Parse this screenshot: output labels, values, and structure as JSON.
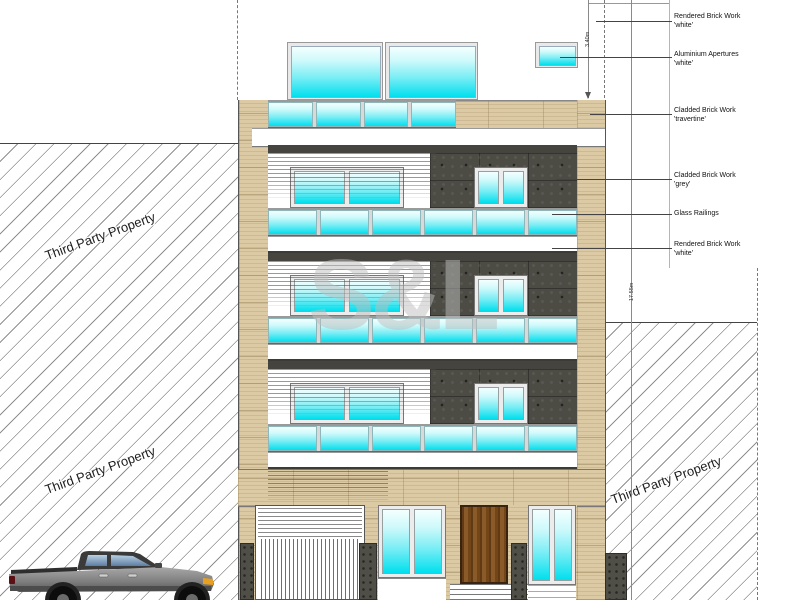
{
  "title": "building-front-elevation",
  "annotations": [
    {
      "label": "Rendered Brick Work",
      "variant": "'white'"
    },
    {
      "label": "Aluminium Apertures",
      "variant": "'white'"
    },
    {
      "label": "Cladded Brick Work",
      "variant": "'travertine'"
    },
    {
      "label": "Cladded Brick Work",
      "variant": "'grey'"
    },
    {
      "label": "Glass Railings",
      "variant": ""
    },
    {
      "label": "Rendered Brick Work",
      "variant": "'white'"
    }
  ],
  "dimensions": {
    "parapet_height": "3.40m",
    "total_height": "17.55m"
  },
  "property": {
    "left_upper": "Third Party Property",
    "left_lower": "Third Party Property",
    "right": "Third Party Property"
  },
  "watermark": "S&L",
  "colors": {
    "glass-top": "#f4ffff",
    "glass-mid": "#7deef5",
    "glass-bottom": "#00dfee",
    "travertine": "#dccaa4",
    "cladding": "#4c4b44",
    "dark-band": "#45443e",
    "wood-dark": "#5f3a14",
    "wood-light": "#8a5a28",
    "hatch-line": "#8f8f8f",
    "line": "#444444"
  }
}
